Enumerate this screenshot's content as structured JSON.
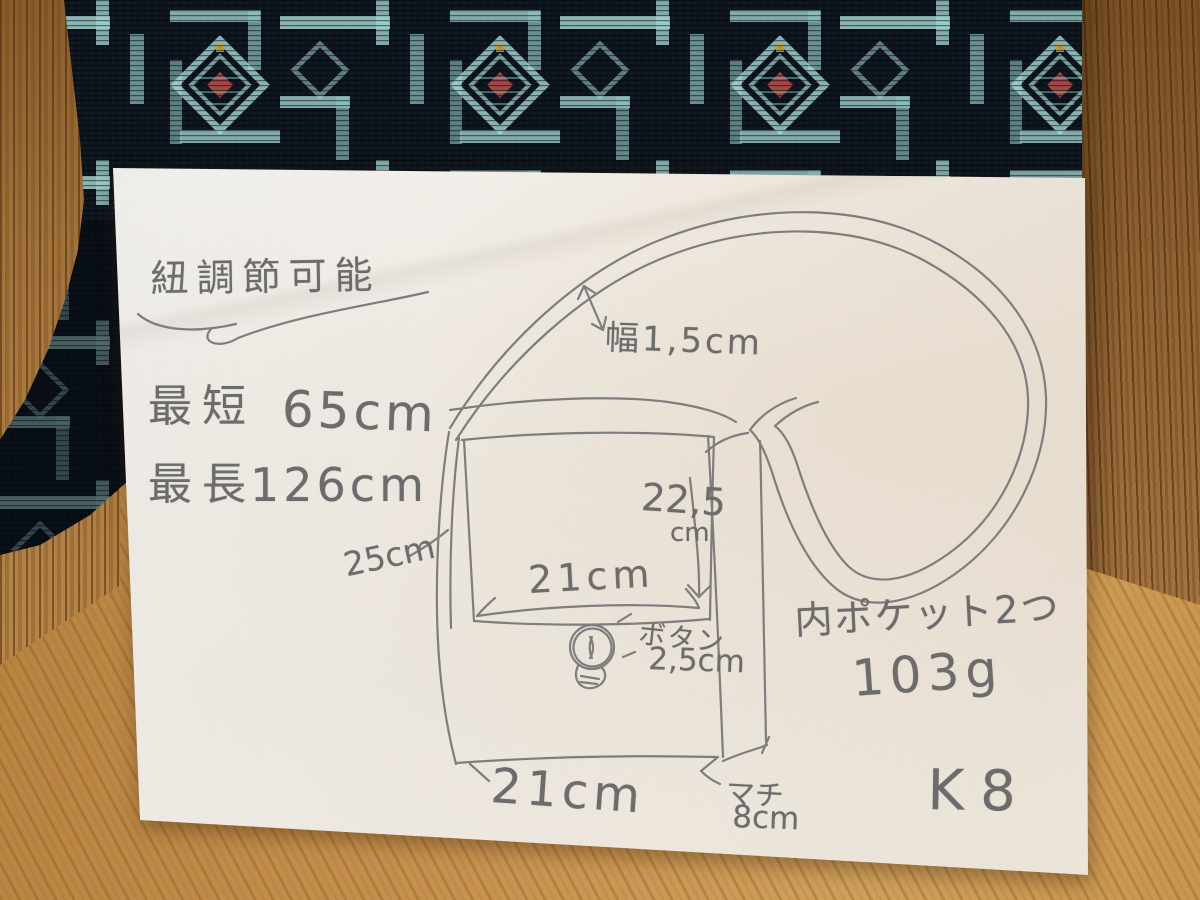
{
  "note": {
    "title": "紐調節可能",
    "strap": {
      "shortest_label": "最短",
      "shortest_value": "65cm",
      "longest_label": "最長",
      "longest_value": "126cm",
      "width": "幅1,5cm"
    },
    "flap": {
      "height": "22,5",
      "height_unit": "cm",
      "width": "21cm"
    },
    "button": {
      "label": "ボタン",
      "size": "2,5cm"
    },
    "side_height": "25cm",
    "pockets": "内ポケット2つ",
    "weight": "103g",
    "bottom_width": "21cm",
    "gusset_label": "マチ",
    "gusset_size": "8cm",
    "item_code": "K8"
  },
  "colors": {
    "pencil": "#6c6c6c",
    "paper": "#f1eee9",
    "fabric_base": "#0c141d",
    "fabric_accent": "#a7d9d6",
    "fabric_red": "#b44a44",
    "fabric_yellow": "#c9a33a",
    "wood": "#b5813f"
  }
}
